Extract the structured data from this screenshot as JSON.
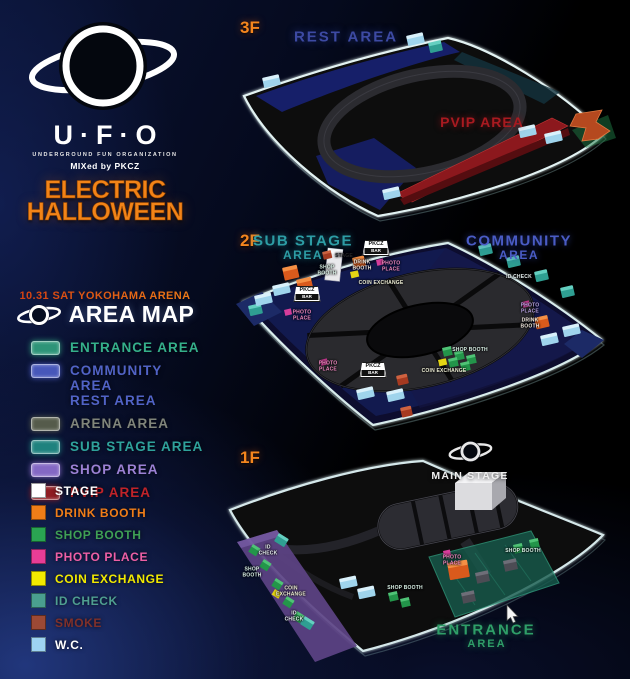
{
  "branding": {
    "logo_text": "U·F·O",
    "org_line": "UNDERGROUND FUN ORGANIZATION",
    "mixed_line": "MIXed by PKCZ",
    "event_line1": "ELECTRIC",
    "event_line2": "HALLOWEEN",
    "accent_orange": "#f28418"
  },
  "area_map_header": {
    "date_line": "10.31 SAT YOKOHAMA ARENA",
    "title": "AREA MAP"
  },
  "legend_areas": [
    {
      "label": "ENTRANCE AREA",
      "color": "#35b08a",
      "swatch": "#2e9478"
    },
    {
      "label": "COMMUNITY AREA\nREST AREA",
      "color": "#5163c6",
      "swatch": "#4757ba"
    },
    {
      "label": "ARENA AREA",
      "color": "#80857a",
      "swatch": "#555b4b"
    },
    {
      "label": "SUB STAGE AREA",
      "color": "#2fa29b",
      "swatch": "#1f827e"
    },
    {
      "label": "SHOP AREA",
      "color": "#9c81d4",
      "swatch": "#8468c4"
    },
    {
      "label": "PVIP AREA",
      "color": "#c02329",
      "swatch": "#8f1d22"
    }
  ],
  "legend_booths": [
    {
      "label": "STAGE",
      "color": "#ffffff",
      "swatch": "#ffffff"
    },
    {
      "label": "DRINK BOOTH",
      "color": "#f07d18",
      "swatch": "#f07d18"
    },
    {
      "label": "SHOP BOOTH",
      "color": "#3fa055",
      "swatch": "#2aa452"
    },
    {
      "label": "PHOTO PLACE",
      "color": "#ee5fa5",
      "swatch": "#e83d96"
    },
    {
      "label": "COIN EXCHANGE",
      "color": "#f2ea00",
      "swatch": "#f2ea00"
    },
    {
      "label": "ID CHECK",
      "color": "#4f9f90",
      "swatch": "#4a9f8f"
    },
    {
      "label": "SMOKE",
      "color": "#80302a",
      "swatch": "#9c4935"
    },
    {
      "label": "W.C.",
      "color": "#ffffff",
      "swatch": "#9ed4f2"
    }
  ],
  "floors": {
    "f3": {
      "label": "3F",
      "rest_area": "REST AREA",
      "pvip_area": "PVIP AREA"
    },
    "f2": {
      "label": "2F",
      "sub_stage_line1": "SUB STAGE",
      "sub_stage_line2": "AREA",
      "community_line1": "COMMUNITY",
      "community_line2": "AREA"
    },
    "f1": {
      "label": "1F",
      "main_stage": "MAIN STAGE",
      "entrance_line1": "ENTRANCE",
      "entrance_line2": "AREA"
    }
  },
  "pkcz_bars": {
    "label_top": "PKCZ",
    "label_bottom": "BAR",
    "positions": [
      {
        "x": 376,
        "y": 248
      },
      {
        "x": 307,
        "y": 294
      },
      {
        "x": 373,
        "y": 370
      }
    ]
  },
  "map_labels": [
    {
      "text": "SHOP\nBOOTH",
      "x": 327,
      "y": 271,
      "c": "#d9f0e6"
    },
    {
      "text": "DRINK\nBOOTH",
      "x": 362,
      "y": 266,
      "c": "#f2e9e0"
    },
    {
      "text": "COIN EXCHANGE",
      "x": 381,
      "y": 284,
      "c": "#efefd6"
    },
    {
      "text": "PHOTO\nPLACE",
      "x": 302,
      "y": 316,
      "c": "#f088c0"
    },
    {
      "text": "PHOTO\nPLACE",
      "x": 391,
      "y": 267,
      "c": "#f088c0"
    },
    {
      "text": "PHOTO\nPLACE",
      "x": 328,
      "y": 367,
      "c": "#f088c0"
    },
    {
      "text": "ID CHECK",
      "x": 519,
      "y": 278,
      "c": "#e8f0f0"
    },
    {
      "text": "PHOTO\nPLACE",
      "x": 530,
      "y": 309,
      "c": "#b8a2e2"
    },
    {
      "text": "DRINK\nBOOTH",
      "x": 530,
      "y": 324,
      "c": "#f2e9e0"
    },
    {
      "text": "SHOP BOOTH",
      "x": 470,
      "y": 351,
      "c": "#d9f0e6"
    },
    {
      "text": "COIN EXCHANGE",
      "x": 444,
      "y": 372,
      "c": "#efefd6"
    },
    {
      "text": "STAGE",
      "x": 344,
      "y": 257,
      "c": "#26262a"
    },
    {
      "text": "ID\nCHECK",
      "x": 268,
      "y": 551,
      "c": "#e8f0f0"
    },
    {
      "text": "SHOP\nBOOTH",
      "x": 252,
      "y": 573,
      "c": "#d9f0e6"
    },
    {
      "text": "COIN\nEXCHANGE",
      "x": 291,
      "y": 592,
      "c": "#efefd6"
    },
    {
      "text": "ID\nCHECK",
      "x": 294,
      "y": 617,
      "c": "#e8f0f0"
    },
    {
      "text": "PHOTO\nPLACE",
      "x": 452,
      "y": 561,
      "c": "#f088c0"
    },
    {
      "text": "SHOP BOOTH",
      "x": 523,
      "y": 552,
      "c": "#d9f0e6"
    },
    {
      "text": "SHOP BOOTH",
      "x": 405,
      "y": 589,
      "c": "#d9f0e6"
    }
  ]
}
